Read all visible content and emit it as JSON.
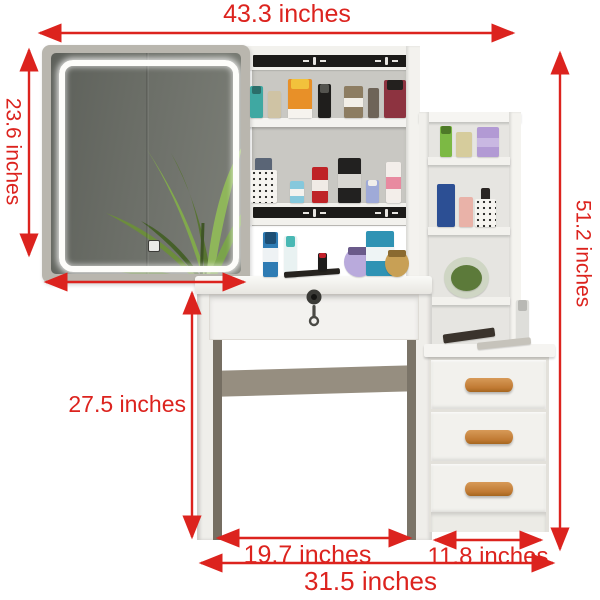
{
  "annotations": {
    "top_width": {
      "label": "43.3 inches"
    },
    "mirror_height": {
      "label": "23.6 inches"
    },
    "total_height": {
      "label": "51.2 inches"
    },
    "desk_height": {
      "label": "27.5 inches"
    },
    "desk_width": {
      "label": "19.7 inches"
    },
    "drawer_unit_width": {
      "label": "11.8 inches"
    },
    "base_width": {
      "label": "31.5 inches"
    }
  },
  "colors": {
    "annotation_red": "#dc231e",
    "furniture_white": "#f3f2ef",
    "hutch_interior_gray": "#c9c8c3",
    "mirror_frame_greige": "#b9b6ae",
    "mirror_glass_gray": "#686b64",
    "led_white": "#fdfdfa",
    "wood_handle_tan": "#c07a33",
    "strip_black": "#1c1b19"
  },
  "items": [
    {
      "name": "teal-spray-bottle",
      "x": 250,
      "y": 86,
      "w": 13,
      "h": 32,
      "color": "#3fa8a2",
      "cap": "#2b6e6a"
    },
    {
      "name": "beige-tube",
      "x": 268,
      "y": 91,
      "w": 13,
      "h": 27,
      "color": "#cfc3a4"
    },
    {
      "name": "orange-sunscreen-tube",
      "x": 288,
      "y": 79,
      "w": 24,
      "h": 39,
      "color": "#e89028",
      "cap": "#f2c23c",
      "band": "#f6f3ee",
      "band_pos": "bottom"
    },
    {
      "name": "black-pump-bottle",
      "x": 318,
      "y": 84,
      "w": 13,
      "h": 34,
      "color": "#1f1e1c",
      "cap": "#54544f"
    },
    {
      "name": "amber-label-bottle",
      "x": 344,
      "y": 86,
      "w": 19,
      "h": 32,
      "color": "#8d7d62",
      "band": "#f2efe8"
    },
    {
      "name": "dark-glass-bottle",
      "x": 368,
      "y": 88,
      "w": 11,
      "h": 30,
      "color": "#6e6458"
    },
    {
      "name": "perfume-dark-red",
      "x": 384,
      "y": 80,
      "w": 22,
      "h": 38,
      "color": "#8d3340",
      "cap": "#23201e"
    },
    {
      "name": "makeup-brushes",
      "x": 255,
      "y": 158,
      "w": 17,
      "h": 14,
      "color": "#5a6576"
    },
    {
      "name": "brush-holder-cup",
      "x": 251,
      "y": 170,
      "w": 26,
      "h": 33,
      "color": "#f6f4f0",
      "dots": true
    },
    {
      "name": "blue-mini-bottle",
      "x": 290,
      "y": 181,
      "w": 14,
      "h": 22,
      "color": "#86c8dc",
      "band": "#f4f2ee"
    },
    {
      "name": "red-deodorant-bottle",
      "x": 312,
      "y": 167,
      "w": 16,
      "h": 36,
      "color": "#bf2327",
      "band": "#f0ebe6"
    },
    {
      "name": "black-cosmetic-tube",
      "x": 338,
      "y": 158,
      "w": 23,
      "h": 45,
      "color": "#222120",
      "band": "#d9d7d2"
    },
    {
      "name": "lavender-bottle",
      "x": 366,
      "y": 180,
      "w": 13,
      "h": 23,
      "color": "#9faad8",
      "cap": "#f0eeea"
    },
    {
      "name": "pink-white-tube",
      "x": 386,
      "y": 162,
      "w": 15,
      "h": 41,
      "color": "#f3eeea",
      "band": "#e88aa0"
    },
    {
      "name": "blue-spray-bottle",
      "x": 263,
      "y": 232,
      "w": 15,
      "h": 45,
      "color": "#2f7cb4",
      "cap": "#1d4e74",
      "band": "#eef2f4"
    },
    {
      "name": "white-teal-spray-can",
      "x": 284,
      "y": 236,
      "w": 13,
      "h": 41,
      "color": "#e9f2f2",
      "cap": "#49b8b4"
    },
    {
      "name": "black-eyeliner-lying",
      "x": 284,
      "y": 270,
      "w": 56,
      "h": 6,
      "color": "#26231f",
      "rot": -4
    },
    {
      "name": "red-lipstick",
      "x": 318,
      "y": 253,
      "w": 9,
      "h": 18,
      "color": "#1e1d1c",
      "cap": "#c2202a"
    },
    {
      "name": "purple-round-perfume",
      "x": 344,
      "y": 247,
      "w": 30,
      "h": 30,
      "color": "#b9aadc",
      "round": true,
      "cap": "#6a5a8a"
    },
    {
      "name": "teal-wipes-pack",
      "x": 366,
      "y": 231,
      "w": 28,
      "h": 45,
      "color": "#2f93b4",
      "band": "#eef4f5"
    },
    {
      "name": "gold-round-perfume",
      "x": 385,
      "y": 250,
      "w": 24,
      "h": 27,
      "color": "#c8a055",
      "round": true,
      "cap": "#8a6a30"
    },
    {
      "name": "green-bottle",
      "x": 440,
      "y": 126,
      "w": 12,
      "h": 31,
      "color": "#7cb944",
      "cap": "#4e7a28"
    },
    {
      "name": "cream-box",
      "x": 456,
      "y": 132,
      "w": 16,
      "h": 25,
      "color": "#d6cc9c"
    },
    {
      "name": "purple-box",
      "x": 477,
      "y": 127,
      "w": 22,
      "h": 30,
      "color": "#b29ad4",
      "band": "#c9b8e2"
    },
    {
      "name": "navy-cosmetic-tube",
      "x": 437,
      "y": 184,
      "w": 18,
      "h": 43,
      "color": "#2c4f94"
    },
    {
      "name": "pink-box",
      "x": 459,
      "y": 197,
      "w": 14,
      "h": 30,
      "color": "#e9b2a8"
    },
    {
      "name": "black-item-in-cup",
      "x": 481,
      "y": 188,
      "w": 9,
      "h": 13,
      "color": "#2a2624"
    },
    {
      "name": "polka-dot-cup",
      "x": 475,
      "y": 199,
      "w": 21,
      "h": 28,
      "color": "#f6f4f0",
      "dots": true
    },
    {
      "name": "glass-terrarium-ball",
      "x": 444,
      "y": 257,
      "w": 45,
      "h": 41,
      "color": "#cfd6c4",
      "round": true
    },
    {
      "name": "terrarium-plant",
      "x": 451,
      "y": 265,
      "w": 31,
      "h": 26,
      "color": "#5c7a3a",
      "round": true
    },
    {
      "name": "white-spray-on-drawer-top",
      "x": 516,
      "y": 300,
      "w": 13,
      "h": 43,
      "color": "#dededa",
      "cap": "#b8b8b4"
    },
    {
      "name": "hair-brush",
      "x": 443,
      "y": 331,
      "w": 52,
      "h": 9,
      "color": "#3a332c",
      "rot": -8
    },
    {
      "name": "comb",
      "x": 477,
      "y": 340,
      "w": 54,
      "h": 7,
      "color": "#c6c3bb",
      "rot": -6
    }
  ]
}
